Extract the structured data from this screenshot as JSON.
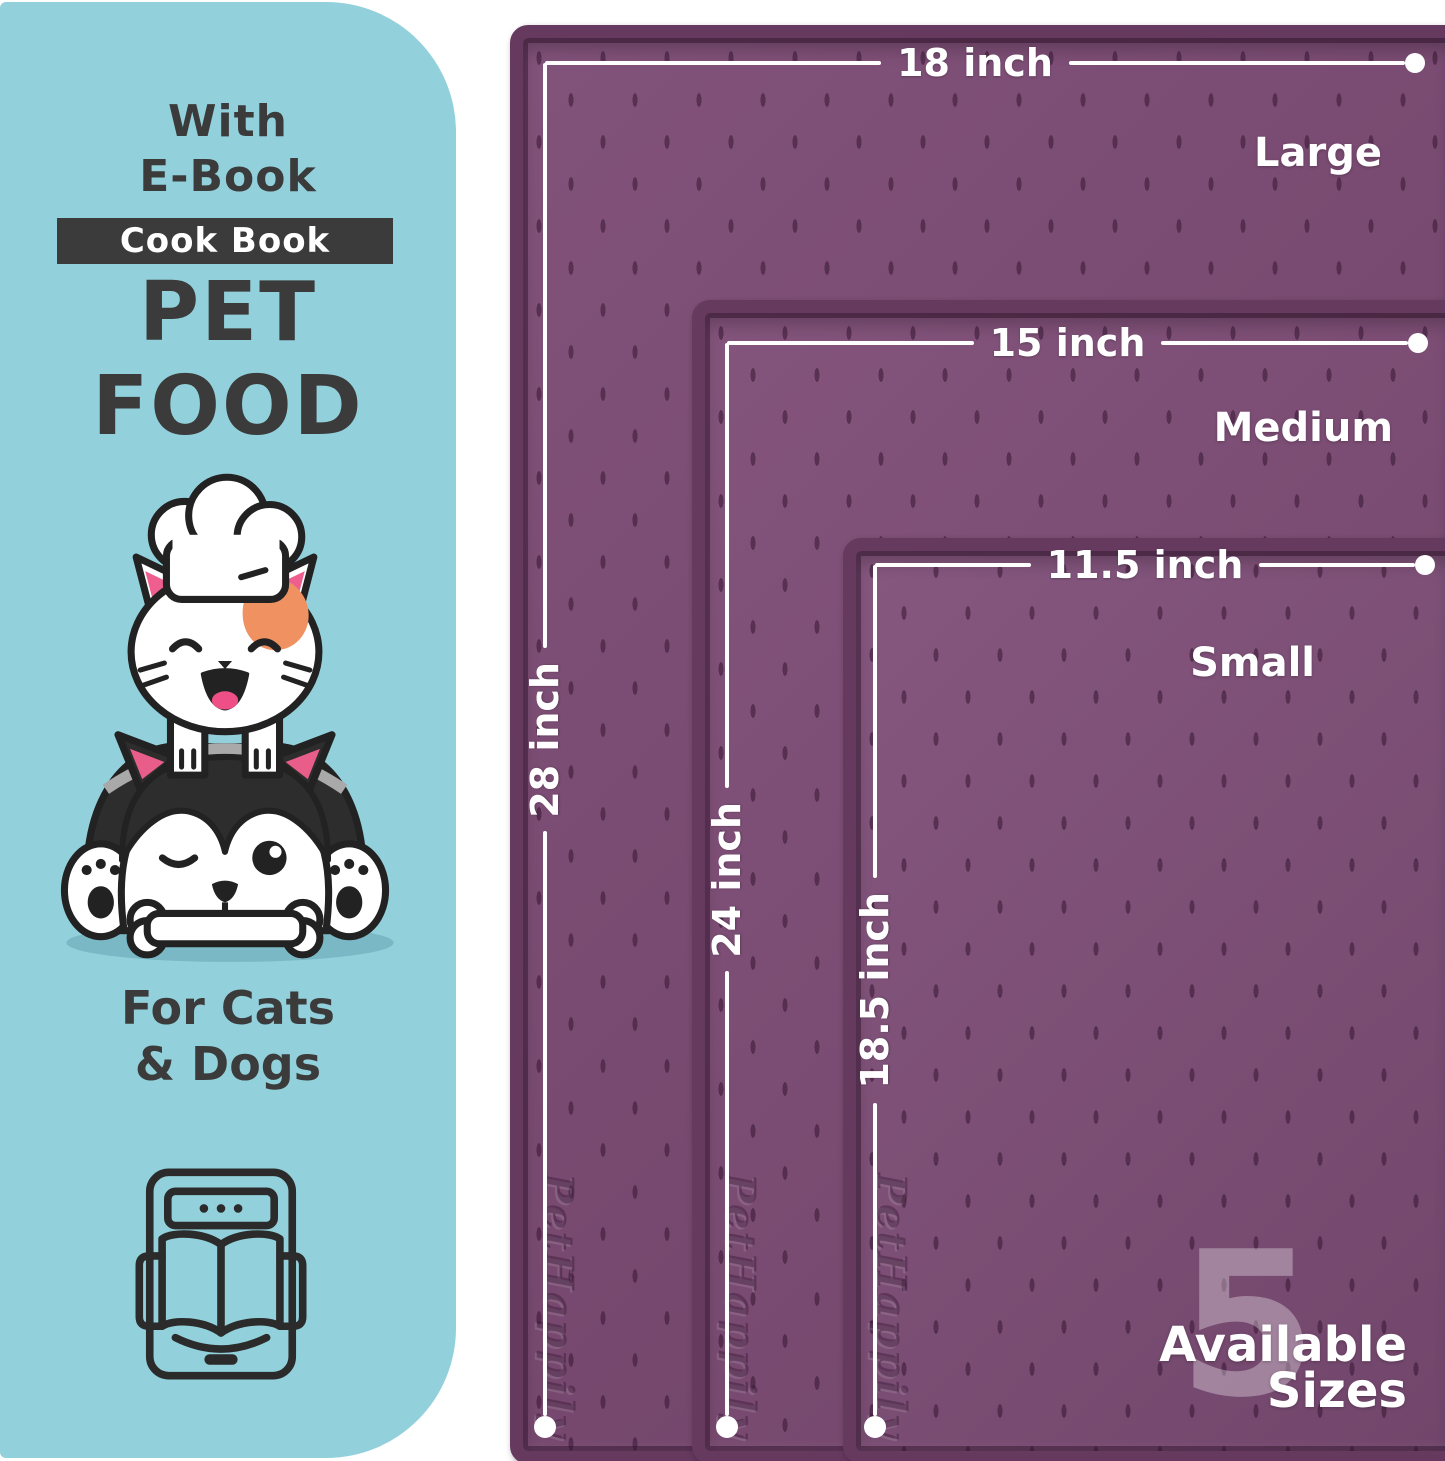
{
  "left_panel": {
    "ebook_line1": "With",
    "ebook_line2": "E-Book",
    "badge": "Cook Book",
    "title_line1": "PET",
    "title_line2": "FOOD",
    "audience_line1": "For Cats",
    "audience_line2": "& Dogs",
    "illustration": "chef-cat-and-winking-dog-with-bone",
    "icon": "ebook-reader-icon",
    "background_color": "#92d1db",
    "text_color": "#3b3b3b"
  },
  "mats": [
    {
      "name": "Large",
      "width_label": "18 inch",
      "height_label": "28 inch"
    },
    {
      "name": "Medium",
      "width_label": "15 inch",
      "height_label": "24 inch"
    },
    {
      "name": "Small",
      "width_label": "11.5 inch",
      "height_label": "18.5 inch"
    }
  ],
  "brand_embossed": "PetHappily",
  "sizes_note": {
    "count": "5",
    "line1": "Available",
    "line2": "Sizes"
  },
  "colors": {
    "mat": "#7b4973",
    "mat_rim": "#66395f",
    "dimension_line": "#ffffff",
    "teal": "#92d1db"
  }
}
